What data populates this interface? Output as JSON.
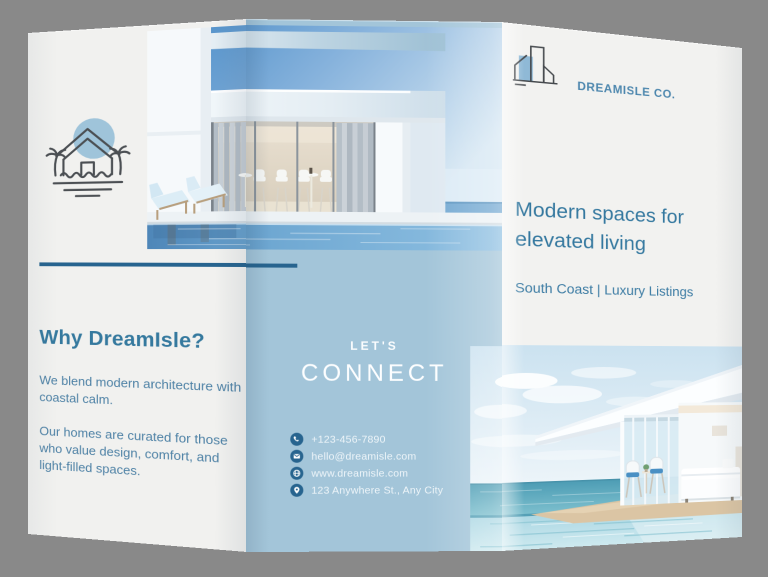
{
  "brand": {
    "name": "DREAMISLE CO.",
    "icon": "buildings-logo-icon",
    "color": "#4d87ae"
  },
  "panels": {
    "left": {
      "icon": "beach-house-icon",
      "heading": "Why DreamIsle?",
      "body1": "We blend modern architecture with coastal calm.",
      "body2": "Our homes are curated for those who value design, comfort, and light-filled spaces."
    },
    "middle": {
      "kicker": "LET'S",
      "title": "CONNECT",
      "contacts": [
        {
          "icon": "phone-icon",
          "text": "+123-456-7890"
        },
        {
          "icon": "envelope-icon",
          "text": "hello@dreamisle.com"
        },
        {
          "icon": "globe-icon",
          "text": "www.dreamisle.com"
        },
        {
          "icon": "location-pin-icon",
          "text": "123 Anywhere St., Any City"
        }
      ]
    },
    "right": {
      "headline": "Modern spaces for elevated living",
      "subhead": "South Coast | Luxury Listings"
    }
  },
  "photos": [
    {
      "name": "villa-pool-photo",
      "description": "Modern white villa with glass wall, curtains, loungers and pool by the sea"
    },
    {
      "name": "beach-villa-photo",
      "description": "White beach villa bedroom with cantilevered roof, infinity pool and ocean"
    }
  ],
  "colors": {
    "background": "#898989",
    "paper": "#f2f2f0",
    "panel_blue": "#a3c5d9",
    "accent": "#27648f",
    "heading_blue": "#35799e",
    "body_blue": "#4d81a5"
  }
}
